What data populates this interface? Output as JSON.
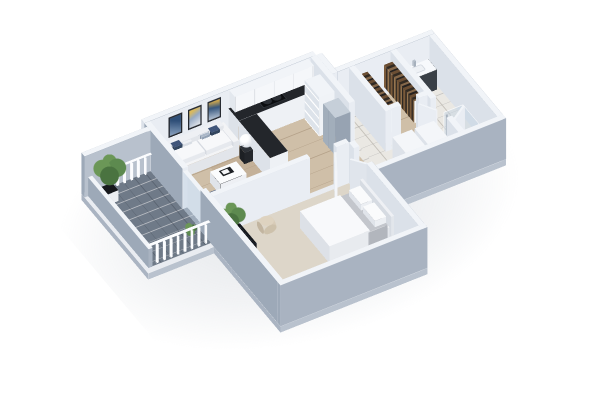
{
  "meta": {
    "description": "3D isometric rendering of a one-bedroom apartment floor plan, viewed from above at an angle, on a white background. No visible text in the image.",
    "view": "isometric-3d-floorplan"
  },
  "scene": {
    "rooms": [
      {
        "name": "balcony"
      },
      {
        "name": "living-room"
      },
      {
        "name": "kitchen"
      },
      {
        "name": "hallway"
      },
      {
        "name": "walk-in-closet"
      },
      {
        "name": "bathroom"
      },
      {
        "name": "laundry-nook"
      },
      {
        "name": "bedroom"
      }
    ],
    "furniture": [
      "sofa",
      "pillows",
      "side-tables",
      "sphere-lamps",
      "coffee-table",
      "armchair",
      "wall-art-triptych",
      "kitchen-l-counter",
      "cooktop",
      "upper-cabinets",
      "pantry-shelf",
      "fridge",
      "clothes-racks",
      "vanity",
      "shower-glass",
      "laundry-units",
      "bed",
      "tv-console",
      "tv",
      "potted-plants",
      "balcony-railing"
    ]
  },
  "palette": {
    "background": "#ffffff",
    "wallTop": "#f1f4f8",
    "wallInnerS": "#e9edf3",
    "wallInnerN": "#e0e5ec",
    "wallInnerE": "#f3f5f9",
    "wallInnerW": "#dbe1e9",
    "wallOuterW": "#9da9b8",
    "wallOuterS": "#a9b3c1",
    "wallOuterE": "#b8c1cd",
    "slabTop": "#e9ecf1",
    "slabS": "#b9c2ce",
    "slabE": "#c2cad5",
    "slabW": "#aab4c2",
    "woodA": "#cfbfa8",
    "woodB": "#c4b199",
    "woodLine": "#b5a28a",
    "tile": "#eae8e3",
    "tileLine": "rgba(160,155,145,0.5)",
    "carpet": "#ddd6c9",
    "balconyFloor": "#6f7a88",
    "balconyLine": "rgba(15,20,30,0.22)",
    "counter": "#23262b",
    "cooktop": "#0c0e11",
    "navy": "#33465f",
    "navyDark": "#283850",
    "navyLight": "#40557a",
    "sofaTop": "#f3f4f6",
    "sofaS": "#e2e5ea",
    "sofaE": "#eceef2",
    "sofaW": "#d6dae1",
    "fridgeTop": "#c6cfd9",
    "fridgeS": "#97a3b2",
    "fridgeE": "#aeb9c5",
    "fridgeW": "#a2aebb",
    "woodTop": "#cdb791",
    "tvFrame": "#17191d",
    "tvScreen": "linear-gradient(180deg,#7fa9d9,#2b4e7c)",
    "plantLight": "#6b9757",
    "plantMid": "#5d8a4f",
    "plantDark": "#4a7340",
    "potGray": "#b3bac3",
    "potDark": "#23262b",
    "glass": "rgba(198,214,228,0.55)",
    "vanityFront": "#3a4047",
    "vanityE": "#454c55",
    "vanityW": "#31373e",
    "blanketTop": "#c3c6cc",
    "blanketSide": "#b2b6bd",
    "artFrame": "#23272e",
    "art1": "linear-gradient(160deg,#8aa2c0,#2f4f78 70%)",
    "art2": "linear-gradient(200deg,#e3e7ec,#97aac4 55%,#d9b95e 85%)",
    "art3": "linear-gradient(170deg,#b9c6d6,#37577e 60%,#caa54f 92%)",
    "railWhite": "#fbfcfe",
    "clothes": "repeating-linear-gradient(180deg,#7a5a3a 0 5px,#3a2f26 5px 9px,#96754f 9px 13px,#2d2823 13px 16px)",
    "clothesTop": "repeating-linear-gradient(180deg,#6b4e33 0 5px,#322a22 5px 9px,#85684a 9px 13px,#262220 13px 16px)",
    "shadow": "rgba(148,158,172,0.28)"
  }
}
